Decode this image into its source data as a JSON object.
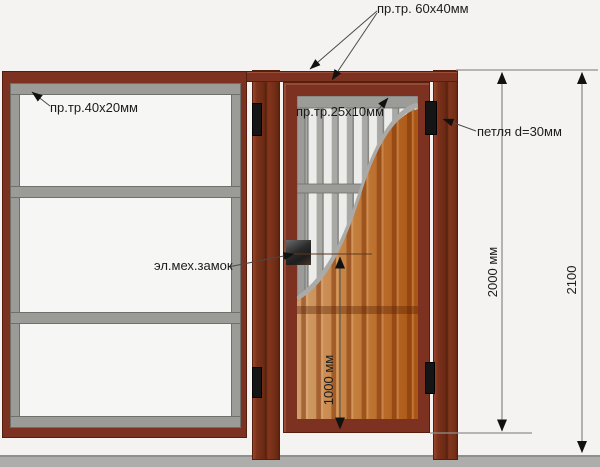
{
  "annotations": {
    "frame_profile": "пр.тр. 60х40мм",
    "fence_profile": "пр.тр.40х20мм",
    "infill_profile": "пр.тр.25х10мм",
    "hinge": "петля d=30мм",
    "lock": "эл.мех.замок"
  },
  "dimensions": {
    "gate_height": "2000 мм",
    "total_height": "2100",
    "lock_height": "1000 мм"
  },
  "colors": {
    "background": "#f4f3f1",
    "panel_white": "#f6f6f4",
    "frame_brown": "#7d3120",
    "frame_brown_dark": "#551e0d",
    "rail_gray": "#9b9b98",
    "rail_gray_dark": "#6f6f6c",
    "slat_bg": "#ececea",
    "slat_bar": "#a8a8a5",
    "slat_edge": "#7f7f7c",
    "sheet_orange_light": "#d09d6b",
    "sheet_orange": "#c5803f",
    "sheet_orange_deep": "#ab5513",
    "sheet_stripe": "#7c2f08",
    "ground_gray": "#adadab",
    "dim_line": "#909090",
    "leader_line": "#4a4a4a",
    "tick_line": "#5a3a22",
    "arrow_black": "#111111",
    "hinge_black": "#151515",
    "text": "#1c1c1c"
  }
}
